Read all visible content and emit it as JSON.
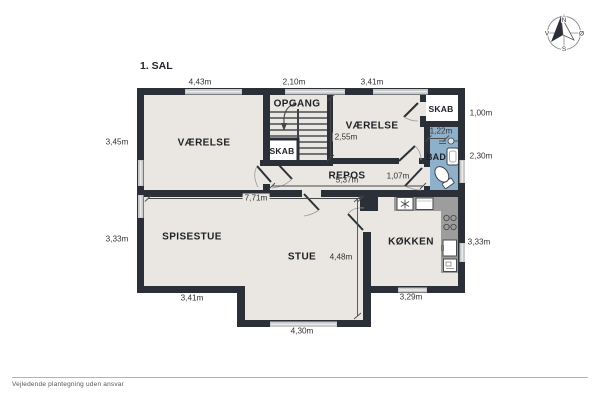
{
  "title": "1. SAL",
  "rooms": {
    "vaerelse_left": "VÆRELSE",
    "vaerelse_right": "VÆRELSE",
    "opgang": "OPGANG",
    "skab_under_stairs": "SKAB",
    "skab_top_right": "SKAB",
    "repos": "REPOS",
    "bad": "BAD",
    "spisestue": "SPISESTUE",
    "stue": "STUE",
    "koekken": "KØKKEN"
  },
  "dimensions": {
    "top_left": "4,43m",
    "top_middle": "2,10m",
    "top_right": "3,41m",
    "right_skab": "1,00m",
    "right_bad": "2,30m",
    "right_koekken": "3,33m",
    "left_vaerelse": "3,45m",
    "left_spisestue": "3,33m",
    "vaerelse_right_height": "2,55m",
    "repos_width": "5,37m",
    "repos_passage": "1,07m",
    "bad_width": "1,22m",
    "stue_top_width": "7,71m",
    "stue_height": "4,48m",
    "bottom_spisestue": "3,41m",
    "bottom_stue": "4,30m",
    "bottom_koekken": "3,29m"
  },
  "compass": {
    "north": "N",
    "south": "S",
    "west": "V",
    "east": "Ø"
  },
  "footer": "Vejledende plantegning uden ansvar",
  "colors": {
    "wall": "#2b2f38",
    "floor": "#eae6e1",
    "bathroom_fill": "#8fb0ca",
    "window": "#c9c9c9",
    "counter": "#9d9d9d",
    "background": "#ffffff"
  }
}
